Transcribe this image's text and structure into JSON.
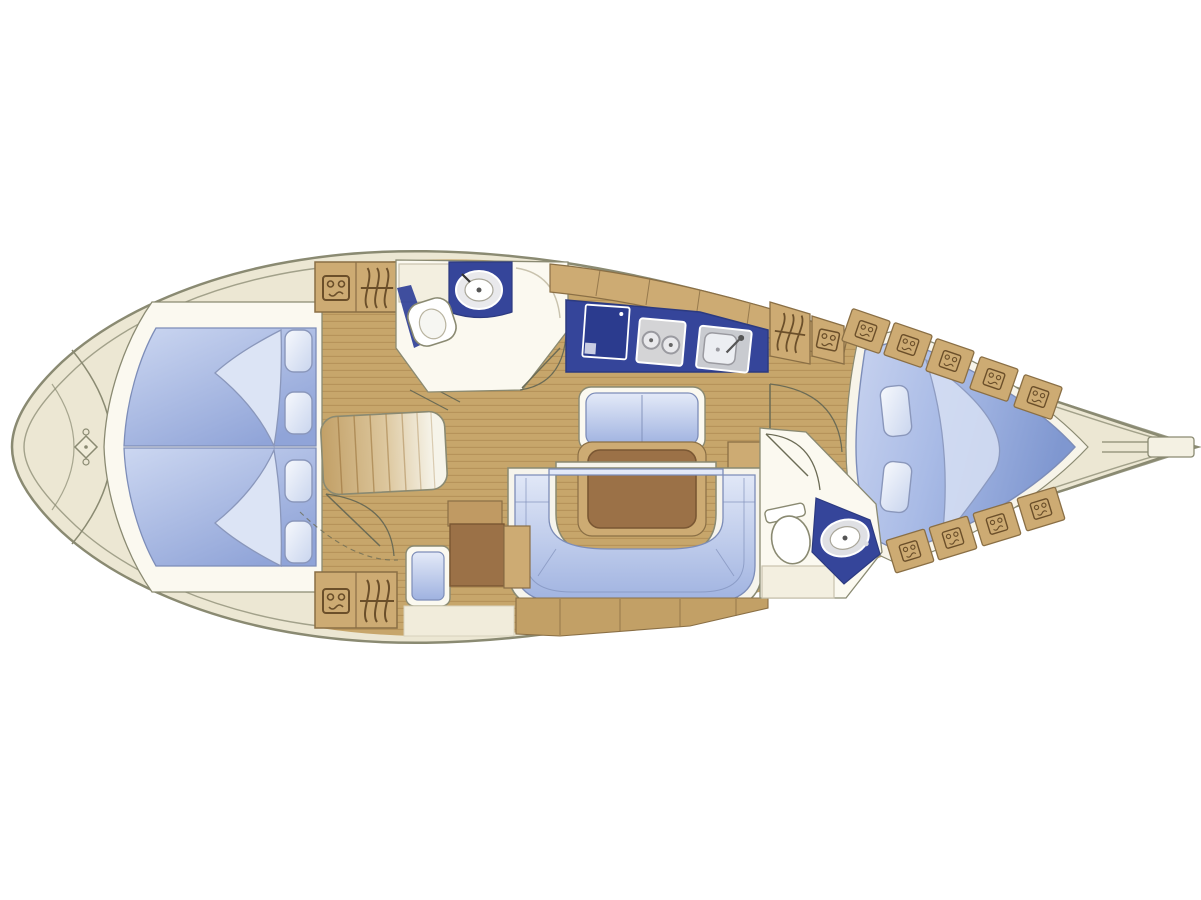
{
  "figure": {
    "type": "sailing-yacht-interior-floor-plan",
    "orientation": {
      "bow": "right",
      "stern": "left"
    },
    "colors": {
      "background": "#ffffff",
      "deck": "#ece7d3",
      "hull_outline": "#8a8a72",
      "floor_wood": "#c7a66b",
      "floor_plank_line": "#a5804a",
      "furniture_wood": "#cdab73",
      "furniture_wood_outline": "#8a6f45",
      "icon_brown": "#6b4f2a",
      "table_wood": "#9b7147",
      "table_wood_outline": "#7a5733",
      "counter_navy": "#35459a",
      "counter_navy_outline": "#2c3a80",
      "fridge_navy": "#2b3b8e",
      "cushion_blue_light": "#dfe7f7",
      "cushion_blue_dark": "#8fa3d6",
      "cushion_outline": "#7d8db8",
      "pillow_outline": "#8a97bb",
      "fixture_white": "#fbf9f0",
      "counter_white": "#f3efe0",
      "appliance_gray": "#d4d4d6",
      "door_line": "#6b6b55"
    },
    "areas": {
      "stern": {
        "features": [
          "transom-curve",
          "rudder-fitting-diamond"
        ]
      },
      "aft_cabin": {
        "features": [
          "double-berth",
          "folded-blanket",
          "folded-blanket",
          "pillow",
          "pillow",
          "pillow",
          "pillow"
        ]
      },
      "companionway": {
        "features": [
          "steps",
          "storage-locker-icon",
          "hanging-locker-icon",
          "storage-locker-icon",
          "hanging-locker-icon",
          "door-arc"
        ]
      },
      "aft_head": {
        "features": [
          "counter",
          "washbasin",
          "toilet",
          "door-arc"
        ]
      },
      "galley": {
        "features": [
          "refrigerator",
          "two-burner-stove",
          "sink",
          "outboard-lockers",
          "hanging-locker-icon",
          "storage-locker-icon"
        ]
      },
      "salon": {
        "features": [
          "bench-settee",
          "dining-table",
          "u-shaped-settee",
          "nav-seat",
          "chart-table",
          "corner-cabinet",
          "stowage-lockers"
        ]
      },
      "forward_head": {
        "features": [
          "toilet",
          "washbasin",
          "counter",
          "door-arc"
        ]
      },
      "forward_cabin": {
        "features": [
          "v-berth",
          "pillow",
          "pillow",
          "folded-blanket",
          "shelf-locker",
          "shelf-locker",
          "shelf-locker",
          "shelf-locker",
          "shelf-locker",
          "shelf-locker",
          "shelf-locker",
          "shelf-locker",
          "shelf-locker"
        ]
      },
      "bow": {
        "features": [
          "anchor-locker-lines",
          "bow-channel",
          "stem-fitting"
        ]
      }
    }
  }
}
